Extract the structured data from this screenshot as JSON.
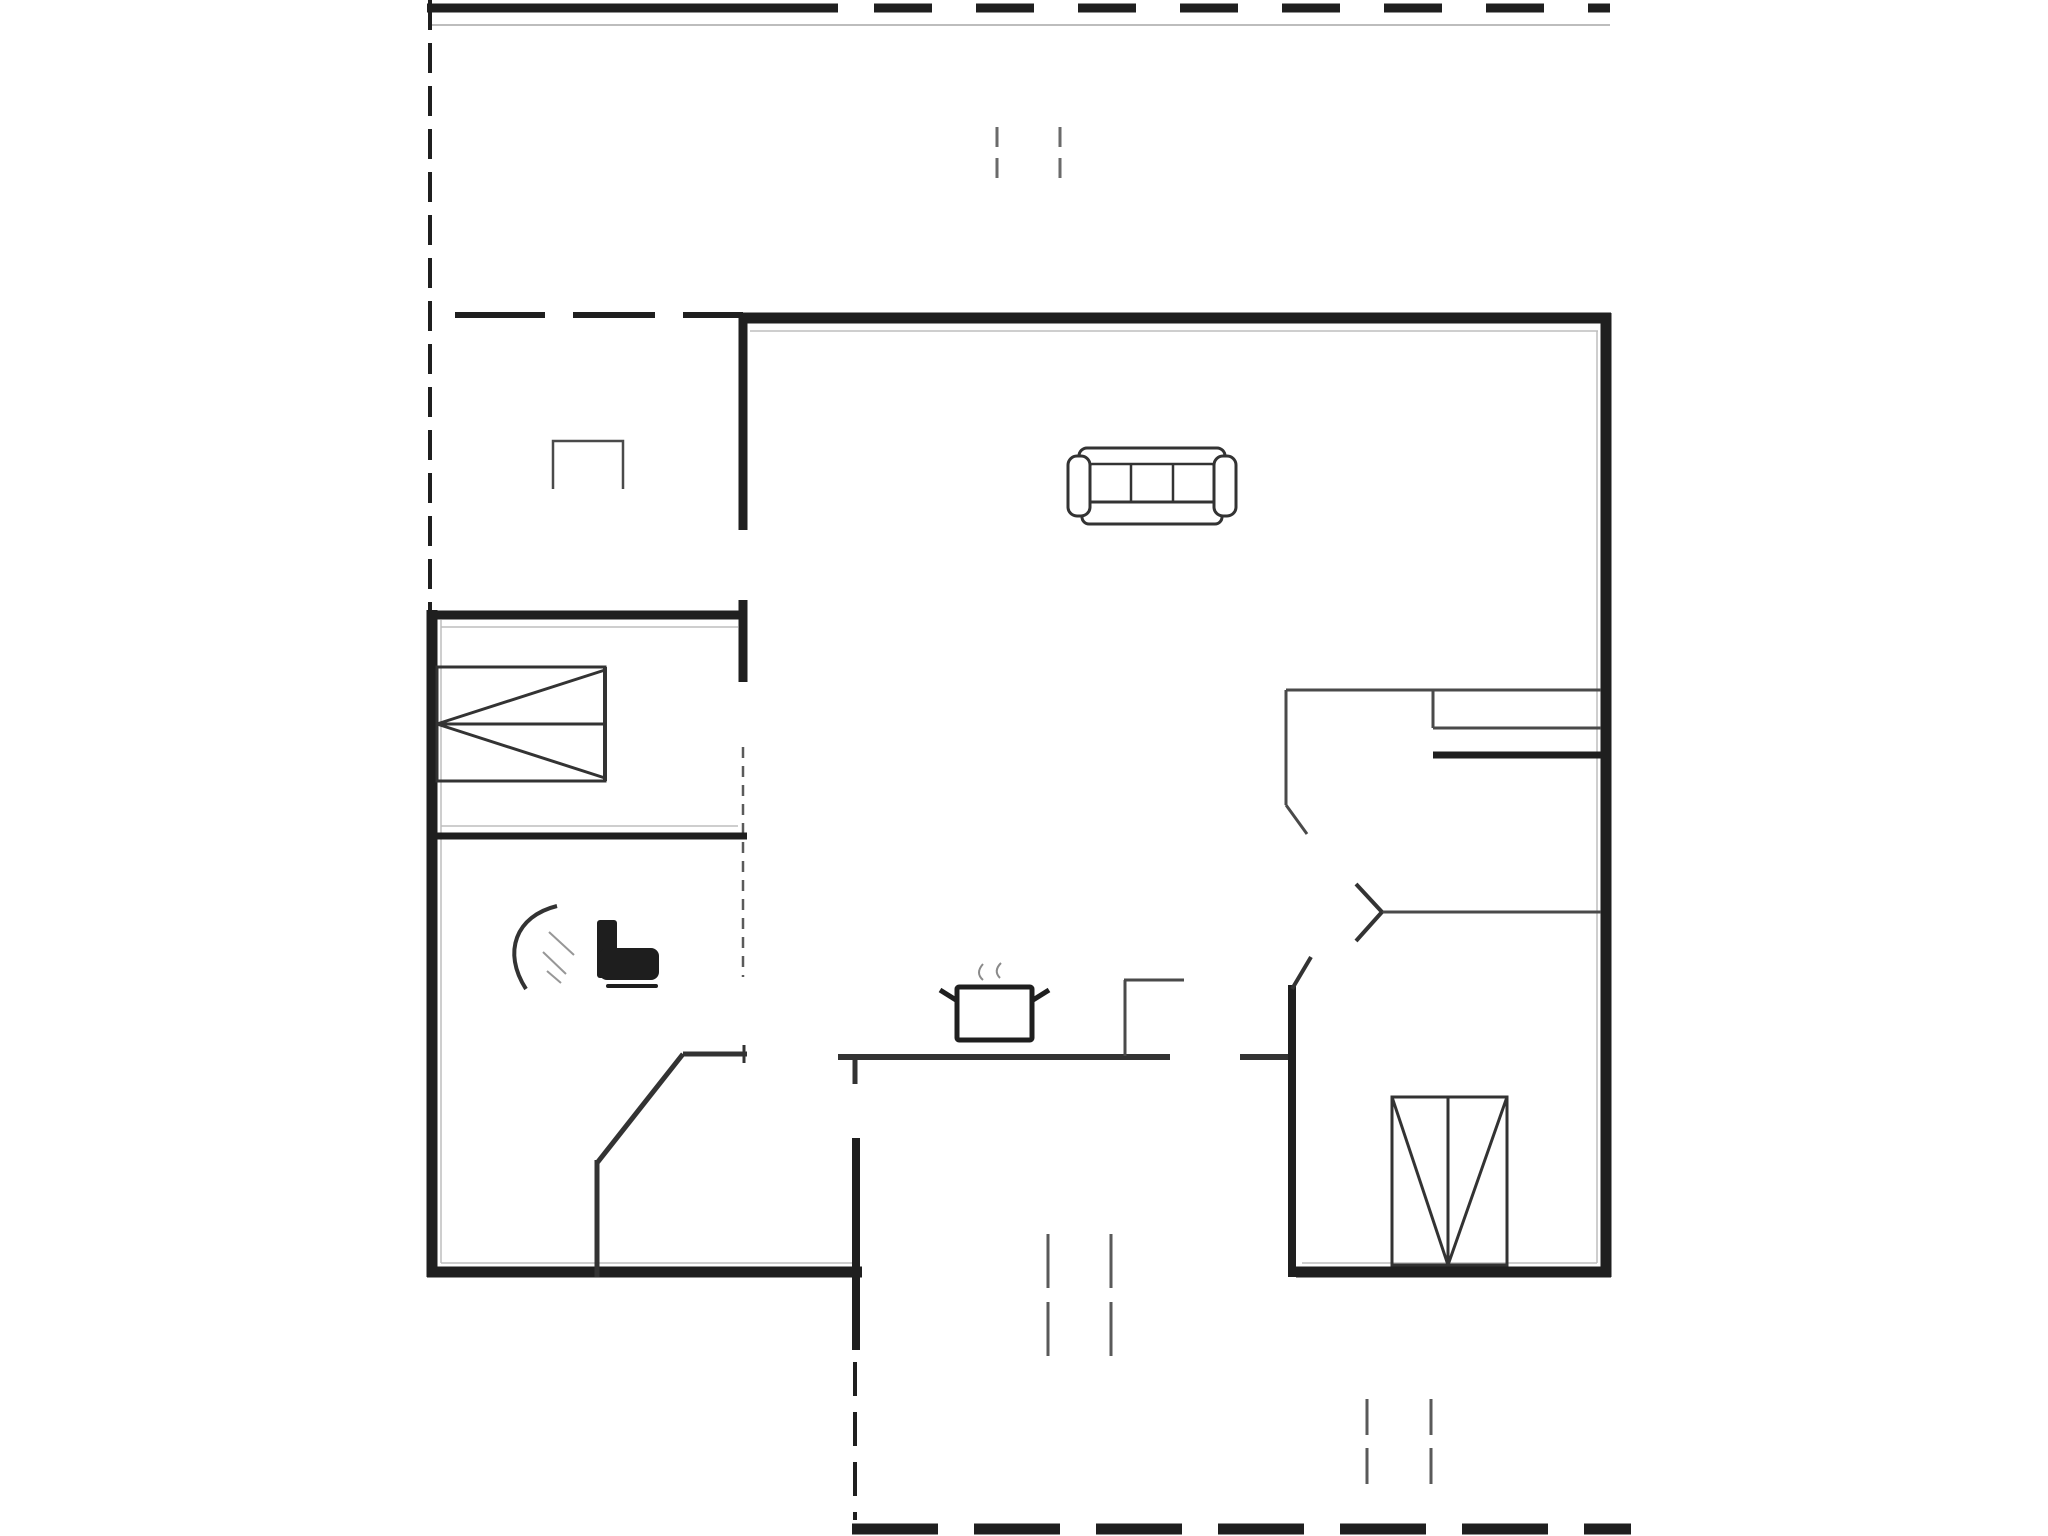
{
  "page": {
    "background": "#ffffff"
  },
  "colors": {
    "wall": "#1f1f1f",
    "medium": "#333333",
    "thin": "#4a4a4a",
    "thin2": "#5a5a5a",
    "tick": "#6a6a6a",
    "faint": "#bdbdbd",
    "steam": "#8a8a8a",
    "hatch": "#979797",
    "white": "#ffffff",
    "black_fill": "#1e1e1e"
  },
  "plan": {
    "canvas": {
      "width": 2048,
      "height": 1536
    },
    "elements": [
      {
        "name": "terrace-top-edge-solid",
        "kind": "line",
        "x1": 427,
        "y1": 8,
        "x2": 838,
        "y2": 8,
        "w": 9,
        "color": "wall"
      },
      {
        "name": "terrace-top-edge-dashed",
        "kind": "line",
        "x1": 874,
        "y1": 8,
        "x2": 1610,
        "y2": 8,
        "w": 9,
        "color": "wall",
        "dash": "58,44"
      },
      {
        "name": "terrace-top-inner-faint",
        "kind": "line",
        "x1": 430,
        "y1": 25,
        "x2": 1610,
        "y2": 25,
        "w": 2,
        "color": "faint"
      },
      {
        "name": "terrace-left-edge",
        "kind": "line",
        "x1": 430,
        "y1": 0,
        "x2": 430,
        "y2": 612,
        "w": 4,
        "color": "wall",
        "dash": "30,13"
      },
      {
        "name": "terrace-gate-tick-1",
        "kind": "line",
        "x1": 997,
        "y1": 127,
        "x2": 997,
        "y2": 180,
        "w": 3,
        "color": "tick",
        "dash": "20,11"
      },
      {
        "name": "terrace-gate-tick-2",
        "kind": "line",
        "x1": 1060,
        "y1": 127,
        "x2": 1060,
        "y2": 180,
        "w": 3,
        "color": "tick",
        "dash": "20,11"
      },
      {
        "name": "porch-boundary-dash-1",
        "kind": "line",
        "x1": 455,
        "y1": 315,
        "x2": 545,
        "y2": 315,
        "w": 6,
        "color": "wall"
      },
      {
        "name": "porch-boundary-dash-2",
        "kind": "line",
        "x1": 573,
        "y1": 315,
        "x2": 655,
        "y2": 315,
        "w": 6,
        "color": "wall"
      },
      {
        "name": "porch-boundary-dash-3",
        "kind": "line",
        "x1": 683,
        "y1": 315,
        "x2": 743,
        "y2": 315,
        "w": 6,
        "color": "wall"
      },
      {
        "name": "exterior-wall-top",
        "kind": "line",
        "x1": 740,
        "y1": 318,
        "x2": 1611,
        "y2": 318,
        "w": 11,
        "color": "wall"
      },
      {
        "name": "exterior-wall-right",
        "kind": "line",
        "x1": 1606,
        "y1": 313,
        "x2": 1606,
        "y2": 1277,
        "w": 11,
        "color": "wall"
      },
      {
        "name": "exterior-wall-bottom-right",
        "kind": "line",
        "x1": 1296,
        "y1": 1272,
        "x2": 1611,
        "y2": 1272,
        "w": 11,
        "color": "wall"
      },
      {
        "name": "exterior-wall-bottom-left",
        "kind": "line",
        "x1": 427,
        "y1": 1272,
        "x2": 862,
        "y2": 1272,
        "w": 11,
        "color": "wall"
      },
      {
        "name": "exterior-wall-left",
        "kind": "line",
        "x1": 432,
        "y1": 610,
        "x2": 432,
        "y2": 1277,
        "w": 11,
        "color": "wall"
      },
      {
        "name": "inner-face-top",
        "kind": "line",
        "x1": 750,
        "y1": 331,
        "x2": 1598,
        "y2": 331,
        "w": 1.5,
        "color": "faint"
      },
      {
        "name": "inner-face-right",
        "kind": "line",
        "x1": 1597,
        "y1": 331,
        "x2": 1597,
        "y2": 1263,
        "w": 1.5,
        "color": "faint"
      },
      {
        "name": "inner-face-bottom-right",
        "kind": "line",
        "x1": 1302,
        "y1": 1263,
        "x2": 1597,
        "y2": 1263,
        "w": 1.5,
        "color": "faint"
      },
      {
        "name": "inner-face-left",
        "kind": "line",
        "x1": 441,
        "y1": 620,
        "x2": 441,
        "y2": 1263,
        "w": 1.5,
        "color": "faint"
      },
      {
        "name": "inner-face-bottom-left",
        "kind": "line",
        "x1": 441,
        "y1": 1263,
        "x2": 853,
        "y2": 1263,
        "w": 1.5,
        "color": "faint"
      },
      {
        "name": "inner-face-bedroom-top",
        "kind": "line",
        "x1": 441,
        "y1": 627,
        "x2": 738,
        "y2": 627,
        "w": 1.5,
        "color": "faint"
      },
      {
        "name": "inner-face-bathroom",
        "kind": "line",
        "x1": 441,
        "y1": 826,
        "x2": 738,
        "y2": 826,
        "w": 1.5,
        "color": "faint"
      },
      {
        "name": "hall-right-wall-upper",
        "kind": "line",
        "x1": 743,
        "y1": 313,
        "x2": 743,
        "y2": 530,
        "w": 9,
        "color": "wall"
      },
      {
        "name": "hall-right-wall-cap",
        "kind": "line",
        "x1": 743,
        "y1": 600,
        "x2": 743,
        "y2": 682,
        "w": 9,
        "color": "wall"
      },
      {
        "name": "bedroom-top-wall",
        "kind": "line",
        "x1": 427,
        "y1": 615,
        "x2": 747,
        "y2": 615,
        "w": 9,
        "color": "wall"
      },
      {
        "name": "bedroom-door-dashline",
        "kind": "line",
        "x1": 743,
        "y1": 747,
        "x2": 743,
        "y2": 977,
        "w": 2.5,
        "color": "thin2",
        "dash": "11,8"
      },
      {
        "name": "bathroom-top-wall",
        "kind": "line",
        "x1": 427,
        "y1": 836,
        "x2": 747,
        "y2": 836,
        "w": 7,
        "color": "wall"
      },
      {
        "name": "bathroom-diagonal-wall",
        "kind": "line",
        "x1": 683,
        "y1": 1054,
        "x2": 597,
        "y2": 1163,
        "w": 5,
        "color": "medium"
      },
      {
        "name": "bathroom-diagonal-vert",
        "kind": "line",
        "x1": 597,
        "y1": 1160,
        "x2": 597,
        "y2": 1277,
        "w": 5,
        "color": "medium"
      },
      {
        "name": "counter-left-segment",
        "kind": "line",
        "x1": 683,
        "y1": 1054,
        "x2": 747,
        "y2": 1054,
        "w": 5,
        "color": "medium"
      },
      {
        "name": "counter-left-endcap",
        "kind": "line",
        "x1": 744,
        "y1": 1045,
        "x2": 744,
        "y2": 1063,
        "w": 3,
        "color": "medium"
      },
      {
        "name": "kitchen-wall-a",
        "kind": "line",
        "x1": 838,
        "y1": 1057,
        "x2": 1170,
        "y2": 1057,
        "w": 6,
        "color": "medium"
      },
      {
        "name": "kitchen-wall-a-stub",
        "kind": "line",
        "x1": 855,
        "y1": 1054,
        "x2": 855,
        "y2": 1084,
        "w": 5,
        "color": "medium"
      },
      {
        "name": "kitchen-wall-b",
        "kind": "line",
        "x1": 1240,
        "y1": 1057,
        "x2": 1296,
        "y2": 1057,
        "w": 6,
        "color": "medium"
      },
      {
        "name": "kitchen-counter-vert",
        "kind": "line",
        "x1": 1125,
        "y1": 980,
        "x2": 1125,
        "y2": 1056,
        "w": 3,
        "color": "thin"
      },
      {
        "name": "kitchen-counter-top",
        "kind": "line",
        "x1": 1124,
        "y1": 980,
        "x2": 1184,
        "y2": 980,
        "w": 3,
        "color": "thin"
      },
      {
        "name": "vestibule-left-wall",
        "kind": "line",
        "x1": 856,
        "y1": 1138,
        "x2": 856,
        "y2": 1350,
        "w": 8,
        "color": "wall"
      },
      {
        "name": "vestibule-left-wall-dashed",
        "kind": "line",
        "x1": 855,
        "y1": 1362,
        "x2": 855,
        "y2": 1520,
        "w": 4,
        "color": "wall",
        "dash": "34,16"
      },
      {
        "name": "bedroom2-left-wall",
        "kind": "line",
        "x1": 1292,
        "y1": 985,
        "x2": 1292,
        "y2": 1277,
        "w": 8,
        "color": "wall"
      },
      {
        "name": "bedroom2-door-jamb-diag",
        "kind": "line",
        "x1": 1292,
        "y1": 989,
        "x2": 1311,
        "y2": 957,
        "w": 4,
        "color": "medium"
      },
      {
        "name": "room-divider-upper",
        "kind": "line",
        "x1": 1286,
        "y1": 690,
        "x2": 1601,
        "y2": 690,
        "w": 3,
        "color": "thin"
      },
      {
        "name": "room-divider-upper-jamb",
        "kind": "line",
        "x1": 1286,
        "y1": 690,
        "x2": 1286,
        "y2": 805,
        "w": 3,
        "color": "thin"
      },
      {
        "name": "room-divider-upper-jamb-diag",
        "kind": "line",
        "x1": 1286,
        "y1": 805,
        "x2": 1307,
        "y2": 834,
        "w": 3,
        "color": "thin"
      },
      {
        "name": "closet-left-edge",
        "kind": "line",
        "x1": 1433,
        "y1": 691,
        "x2": 1433,
        "y2": 728,
        "w": 3,
        "color": "thin"
      },
      {
        "name": "closet-top-edge",
        "kind": "line",
        "x1": 1433,
        "y1": 728,
        "x2": 1601,
        "y2": 728,
        "w": 3,
        "color": "thin"
      },
      {
        "name": "closet-bottom-edge",
        "kind": "line",
        "x1": 1433,
        "y1": 755,
        "x2": 1601,
        "y2": 755,
        "w": 7,
        "color": "wall"
      },
      {
        "name": "room-divider-lower",
        "kind": "line",
        "x1": 1382,
        "y1": 912,
        "x2": 1601,
        "y2": 912,
        "w": 3,
        "color": "thin"
      },
      {
        "name": "door-chevron-upper-arm",
        "kind": "line",
        "x1": 1382,
        "y1": 912,
        "x2": 1356,
        "y2": 884,
        "w": 4,
        "color": "medium"
      },
      {
        "name": "door-chevron-lower-arm",
        "kind": "line",
        "x1": 1382,
        "y1": 912,
        "x2": 1356,
        "y2": 941,
        "w": 4,
        "color": "medium"
      },
      {
        "name": "vestibule-window-tick-1",
        "kind": "line",
        "x1": 1048,
        "y1": 1234,
        "x2": 1048,
        "y2": 1360,
        "w": 3,
        "color": "thin2",
        "dash": "54,14"
      },
      {
        "name": "vestibule-window-tick-2",
        "kind": "line",
        "x1": 1111,
        "y1": 1234,
        "x2": 1111,
        "y2": 1360,
        "w": 3,
        "color": "thin2",
        "dash": "54,14"
      },
      {
        "name": "terrace-bottom-tick-1",
        "kind": "line",
        "x1": 1367,
        "y1": 1399,
        "x2": 1367,
        "y2": 1484,
        "w": 3,
        "color": "thin2",
        "dash": "36,13"
      },
      {
        "name": "terrace-bottom-tick-2",
        "kind": "line",
        "x1": 1431,
        "y1": 1399,
        "x2": 1431,
        "y2": 1484,
        "w": 3,
        "color": "thin2",
        "dash": "36,13"
      },
      {
        "name": "terrace-bottom-edge-dashed",
        "kind": "line",
        "x1": 852,
        "y1": 1529,
        "x2": 1631,
        "y2": 1529,
        "w": 11,
        "color": "wall",
        "dash": "86,36"
      }
    ],
    "furniture": [
      {
        "name": "fireplace-box-icon",
        "parts": [
          {
            "kind": "polyline",
            "points": "553,489 553,441 623,441 623,489",
            "w": 2.5,
            "color": "thin",
            "fill": "none"
          }
        ]
      },
      {
        "name": "single-bed-icon-left",
        "parts": [
          {
            "kind": "rect",
            "x": 437,
            "y": 667,
            "width": 168,
            "height": 114,
            "w": 3,
            "color": "medium",
            "fill": "none"
          },
          {
            "kind": "line",
            "x1": 437,
            "y1": 724,
            "x2": 605,
            "y2": 724,
            "w": 3,
            "color": "medium"
          },
          {
            "kind": "line",
            "x1": 437,
            "y1": 724,
            "x2": 605,
            "y2": 670,
            "w": 3,
            "color": "medium"
          },
          {
            "kind": "line",
            "x1": 437,
            "y1": 724,
            "x2": 605,
            "y2": 778,
            "w": 3,
            "color": "medium"
          },
          {
            "kind": "line",
            "x1": 605,
            "y1": 667,
            "x2": 605,
            "y2": 781,
            "w": 4,
            "color": "medium"
          }
        ]
      },
      {
        "name": "single-bed-icon-right",
        "parts": [
          {
            "kind": "rect",
            "x": 1392,
            "y": 1097,
            "width": 115,
            "height": 168,
            "w": 3,
            "color": "medium",
            "fill": "none"
          },
          {
            "kind": "line",
            "x1": 1448,
            "y1": 1097,
            "x2": 1448,
            "y2": 1265,
            "w": 3,
            "color": "medium"
          },
          {
            "kind": "line",
            "x1": 1392,
            "y1": 1097,
            "x2": 1448,
            "y2": 1265,
            "w": 3,
            "color": "medium"
          },
          {
            "kind": "line",
            "x1": 1507,
            "y1": 1097,
            "x2": 1448,
            "y2": 1265,
            "w": 3,
            "color": "medium"
          }
        ]
      },
      {
        "name": "sofa-icon",
        "parts": [
          {
            "kind": "rect",
            "x": 1079,
            "y": 448,
            "width": 146,
            "height": 22,
            "rx": 8,
            "w": 3,
            "color": "medium",
            "fill": "white"
          },
          {
            "kind": "rect",
            "x": 1090,
            "y": 464,
            "width": 124,
            "height": 42,
            "rx": 2,
            "w": 2.5,
            "color": "medium",
            "fill": "white"
          },
          {
            "kind": "line",
            "x1": 1131,
            "y1": 464,
            "x2": 1131,
            "y2": 506,
            "w": 2.5,
            "color": "medium"
          },
          {
            "kind": "line",
            "x1": 1173,
            "y1": 464,
            "x2": 1173,
            "y2": 506,
            "w": 2.5,
            "color": "medium"
          },
          {
            "kind": "rect",
            "x": 1082,
            "y": 502,
            "width": 140,
            "height": 22,
            "rx": 7,
            "w": 3,
            "color": "medium",
            "fill": "white"
          },
          {
            "kind": "rect",
            "x": 1068,
            "y": 456,
            "width": 22,
            "height": 60,
            "rx": 9,
            "w": 3,
            "color": "medium",
            "fill": "white"
          },
          {
            "kind": "rect",
            "x": 1214,
            "y": 456,
            "width": 22,
            "height": 60,
            "rx": 9,
            "w": 3,
            "color": "medium",
            "fill": "white"
          }
        ]
      },
      {
        "name": "toilet-icon",
        "parts": [
          {
            "kind": "rect",
            "x": 597,
            "y": 920,
            "width": 20,
            "height": 58,
            "rx": 3,
            "w": 0,
            "color": "black_fill",
            "fill": "black_fill"
          },
          {
            "kind": "rect",
            "x": 599,
            "y": 948,
            "width": 60,
            "height": 32,
            "rx": 8,
            "w": 0,
            "color": "black_fill",
            "fill": "black_fill"
          },
          {
            "kind": "rect",
            "x": 606,
            "y": 984,
            "width": 52,
            "height": 4,
            "rx": 2,
            "w": 0,
            "color": "black_fill",
            "fill": "black_fill"
          }
        ]
      },
      {
        "name": "shower-icon",
        "parts": [
          {
            "kind": "path",
            "d": "M 557 906 C 516 916 502 952 526 989",
            "w": 4,
            "color": "medium",
            "fill": "none"
          },
          {
            "kind": "line",
            "x1": 549,
            "y1": 932,
            "x2": 574,
            "y2": 955,
            "w": 2,
            "color": "hatch"
          },
          {
            "kind": "line",
            "x1": 543,
            "y1": 952,
            "x2": 566,
            "y2": 974,
            "w": 2,
            "color": "hatch"
          },
          {
            "kind": "line",
            "x1": 547,
            "y1": 971,
            "x2": 561,
            "y2": 983,
            "w": 2,
            "color": "hatch"
          }
        ]
      },
      {
        "name": "cooking-pot-icon",
        "parts": [
          {
            "kind": "rect",
            "x": 957,
            "y": 987,
            "width": 75,
            "height": 53,
            "rx": 2,
            "w": 5,
            "color": "wall",
            "fill": "white"
          },
          {
            "kind": "line",
            "x1": 956,
            "y1": 1000,
            "x2": 940,
            "y2": 990,
            "w": 5,
            "color": "wall"
          },
          {
            "kind": "line",
            "x1": 1033,
            "y1": 1000,
            "x2": 1049,
            "y2": 990,
            "w": 5,
            "color": "wall"
          },
          {
            "kind": "path",
            "d": "M 983 980 q -8 -7 0 -16",
            "w": 2,
            "color": "steam",
            "fill": "none"
          },
          {
            "kind": "path",
            "d": "M 1000 978 q -7 -7 1 -15",
            "w": 2,
            "color": "steam",
            "fill": "none"
          }
        ]
      }
    ]
  }
}
